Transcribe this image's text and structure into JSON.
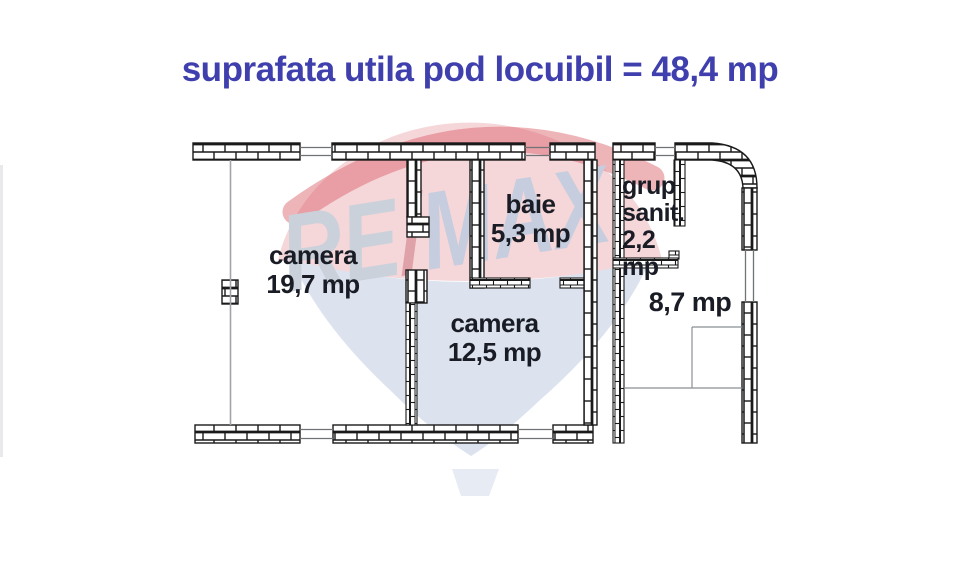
{
  "title": {
    "text": "suprafata utila pod locuibil = 48,4 mp",
    "color": "#3f3fae"
  },
  "watermark": {
    "re": "RE",
    "slash": "/",
    "max": "MAX"
  },
  "rooms": {
    "camera_19": {
      "name": "camera",
      "area": "19,7 mp"
    },
    "baie": {
      "name": "baie",
      "area": "5,3 mp"
    },
    "camera_12": {
      "name": "camera",
      "area": "12,5 mp"
    },
    "grup_sanitar": {
      "name_line1": "grup",
      "name_line2": "sanit.",
      "area": "2,2 mp"
    },
    "hol": {
      "area": "8,7 mp"
    }
  },
  "colors": {
    "title_blue": "#3f3fae",
    "label_text": "#191c24",
    "wall_line": "#1a1a1a",
    "balloon_pink": "#f2c8cc",
    "balloon_red": "#da5a64",
    "balloon_blue": "#dce3ee",
    "basket_blue": "#e7ebf3",
    "watermark_re": "#cad1da",
    "watermark_slash": "#dfa2a9",
    "watermark_max": "#c5cdde"
  }
}
